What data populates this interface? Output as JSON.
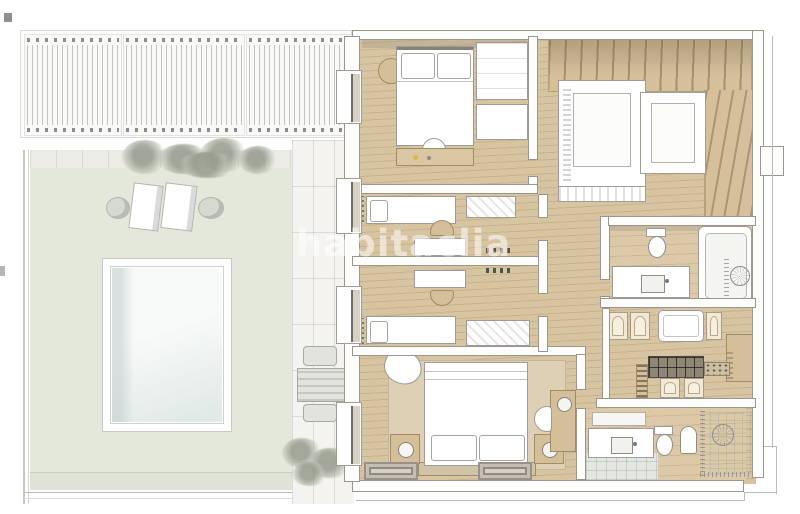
{
  "watermark": {
    "text": "habitaclia"
  },
  "palette": {
    "page-bg": "#ffffff",
    "wood": "#d7c4a0",
    "wood-dark": "#d5c09a",
    "wall-fill": "#fdfdfc",
    "wall-edge": "#9a968e",
    "deck": "#e4e8db",
    "pool-water": "#eef3f2",
    "coping": "#fcfdfc",
    "tile": "#f4f3ef",
    "cream-door": "#f2e8d3",
    "furn-white": "#ffffff",
    "furn-edge": "#a09c95",
    "furn-tan": "#d4bf98",
    "rug": "#ddd0b5",
    "shadow-line": "#bdbab4",
    "accent-yellow": "#d8b93c"
  },
  "scene": {
    "type": "3d-floor-plan-render",
    "outdoor_elements": [
      "pergola",
      "terrace-deck",
      "paved-path",
      "swimming-pool",
      "sun-loungers",
      "side-tables",
      "patio-table",
      "patio-chairs",
      "shrubs"
    ],
    "rooms": [
      "bedroom-top",
      "staircase",
      "twin-room-a",
      "twin-room-b",
      "hallway",
      "main-bathroom",
      "wardrobe-closet",
      "master-bedroom",
      "master-bathroom",
      "corner-shower"
    ]
  }
}
